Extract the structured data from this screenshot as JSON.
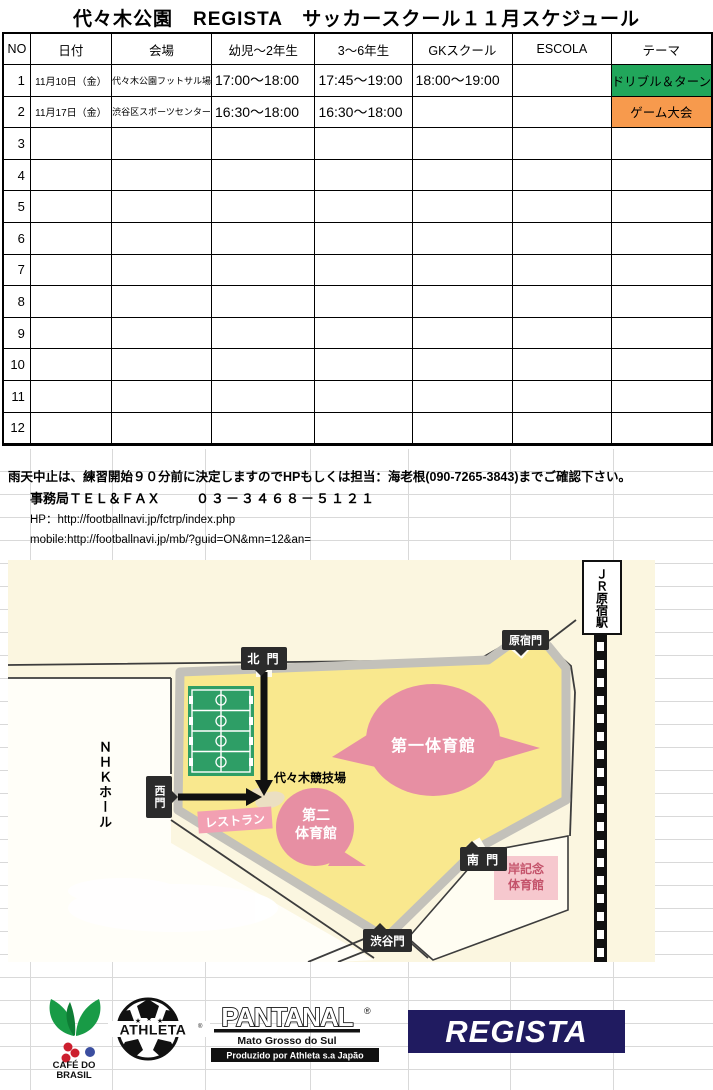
{
  "title": "代々木公園　REGISTA　サッカースクール１１月スケジュール",
  "schedule_table": {
    "headers": [
      "NO",
      "日付",
      "会場",
      "幼児～2年生",
      "3～6年生",
      "GKスクール",
      "ESCOLA",
      "テーマ"
    ],
    "rows": [
      {
        "no": "1",
        "date": "11月10日（金）",
        "venue": "代々木公園フットサル場",
        "infant": "17:00～18:00",
        "upper": "17:45～19:00",
        "gk": "18:00～19:00",
        "escola": "",
        "theme": "ドリブル＆ターン",
        "theme_bg": "#21A65B"
      },
      {
        "no": "2",
        "date": "11月17日（金）",
        "venue": "渋谷区スポーツセンター",
        "infant": "16:30～18:00",
        "upper": "16:30～18:00",
        "gk": "",
        "escola": "",
        "theme": "ゲーム大会",
        "theme_bg": "#F79A4D"
      },
      {
        "no": "3",
        "date": "",
        "venue": "",
        "infant": "",
        "upper": "",
        "gk": "",
        "escola": "",
        "theme": "",
        "theme_bg": ""
      },
      {
        "no": "4",
        "date": "",
        "venue": "",
        "infant": "",
        "upper": "",
        "gk": "",
        "escola": "",
        "theme": "",
        "theme_bg": ""
      },
      {
        "no": "5",
        "date": "",
        "venue": "",
        "infant": "",
        "upper": "",
        "gk": "",
        "escola": "",
        "theme": "",
        "theme_bg": ""
      },
      {
        "no": "6",
        "date": "",
        "venue": "",
        "infant": "",
        "upper": "",
        "gk": "",
        "escola": "",
        "theme": "",
        "theme_bg": ""
      },
      {
        "no": "7",
        "date": "",
        "venue": "",
        "infant": "",
        "upper": "",
        "gk": "",
        "escola": "",
        "theme": "",
        "theme_bg": ""
      },
      {
        "no": "8",
        "date": "",
        "venue": "",
        "infant": "",
        "upper": "",
        "gk": "",
        "escola": "",
        "theme": "",
        "theme_bg": ""
      },
      {
        "no": "9",
        "date": "",
        "venue": "",
        "infant": "",
        "upper": "",
        "gk": "",
        "escola": "",
        "theme": "",
        "theme_bg": ""
      },
      {
        "no": "10",
        "date": "",
        "venue": "",
        "infant": "",
        "upper": "",
        "gk": "",
        "escola": "",
        "theme": "",
        "theme_bg": ""
      },
      {
        "no": "11",
        "date": "",
        "venue": "",
        "infant": "",
        "upper": "",
        "gk": "",
        "escola": "",
        "theme": "",
        "theme_bg": ""
      },
      {
        "no": "12",
        "date": "",
        "venue": "",
        "infant": "",
        "upper": "",
        "gk": "",
        "escola": "",
        "theme": "",
        "theme_bg": ""
      }
    ]
  },
  "notes": {
    "rain_notice": "雨天中止は、練習開始９０分前に決定しますのでHPもしくは担当：海老根(090-7265-3843)までご確認下さい。",
    "office_label": "事務局ＴＥＬ＆ＦＡＸ",
    "office_number": "０３－３４６８－５１２１",
    "hp": "HP：http://footballnavi.jp/fctrp/index.php",
    "mobile": "mobile:http://footballnavi.jp/mb/?guid=ON&mn=12&an="
  },
  "map": {
    "labels": {
      "north_gate": "北 門",
      "harajuku_gate": "原宿門",
      "west_gate": "西門",
      "south_gate": "南 門",
      "shibuya_gate": "渋谷門",
      "nhk_hall": "ＮＨＫホール",
      "jr_station": "ＪＲ原宿駅",
      "gym1": "第一体育館",
      "gym2_line1": "第二",
      "gym2_line2": "体育館",
      "yoyogi_stadium": "代々木競技場",
      "restaurant": "レストラン",
      "kishi_line1": "岸記念",
      "kishi_line2": "体育館"
    }
  },
  "logos": {
    "cafe_line1": "CAFÉ DO",
    "cafe_line2": "BRASIL",
    "athleta": "ATHLETA",
    "athleta_reg": "®",
    "pantanal": "PANTANAL",
    "pantanal_reg": "®",
    "pantanal_sub1": "Mato Grosso do Sul",
    "pantanal_sub2": "Produzido por Athleta s.a Japão",
    "regista": "REGISTA"
  },
  "colors": {
    "theme_green": "#21A65B",
    "theme_orange": "#F79A4D",
    "map_cream": "#FBF6E0",
    "park_yellow": "#F9E88E",
    "gym_pink": "#E78FA3",
    "regista_navy": "#201B60"
  }
}
